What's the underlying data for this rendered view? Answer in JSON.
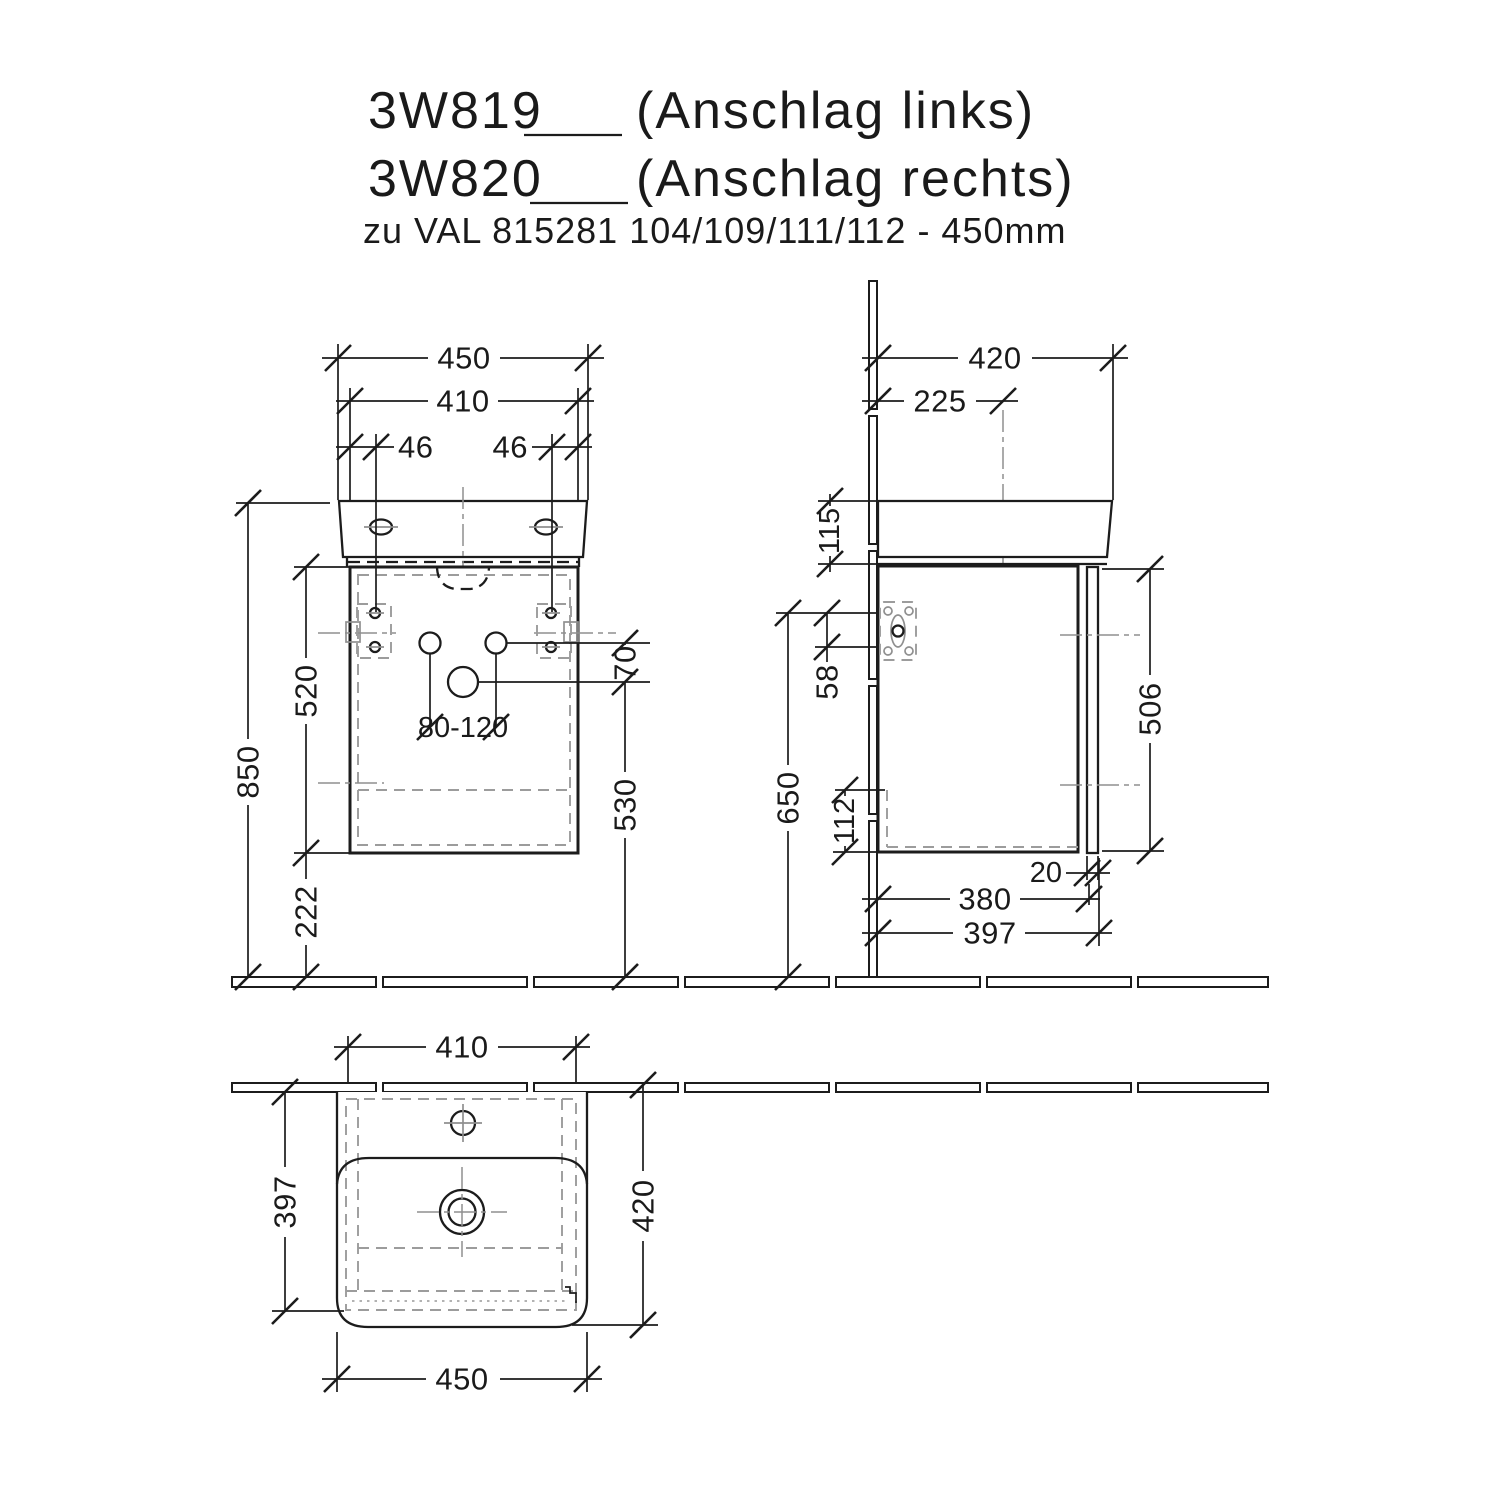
{
  "title": {
    "product_code_left": "3W819",
    "variant_left": "(Anschlag links)",
    "product_code_right": "3W820",
    "variant_right": "(Anschlag rechts)",
    "subtitle": "zu VAL 815281 104/109/111/112 - 450mm"
  },
  "front_view": {
    "overall_width_mm": "450",
    "carcass_width_mm": "410",
    "fixing_offset_left_mm": "46",
    "fixing_offset_right_mm": "46",
    "total_height_mm": "850",
    "carcass_height_mm": "520",
    "floor_clearance_mm": "222",
    "drain_height_mm": "530",
    "hole_spacing_mm": "70",
    "supply_range_mm": "80-120"
  },
  "side_view": {
    "basin_depth_mm": "420",
    "tap_center_depth_mm": "225",
    "basin_rim_height_mm": "115",
    "hinge_axis_offset_mm": "58",
    "reference_height_mm": "650",
    "recess_height_mm": "112",
    "door_height_mm": "506",
    "door_thickness_mm": "20",
    "carcass_depth_mm": "380",
    "total_depth_mm": "397"
  },
  "plan_view": {
    "carcass_width_mm": "410",
    "carcass_depth_mm": "397",
    "basin_depth_mm": "420",
    "basin_width_mm": "450"
  }
}
